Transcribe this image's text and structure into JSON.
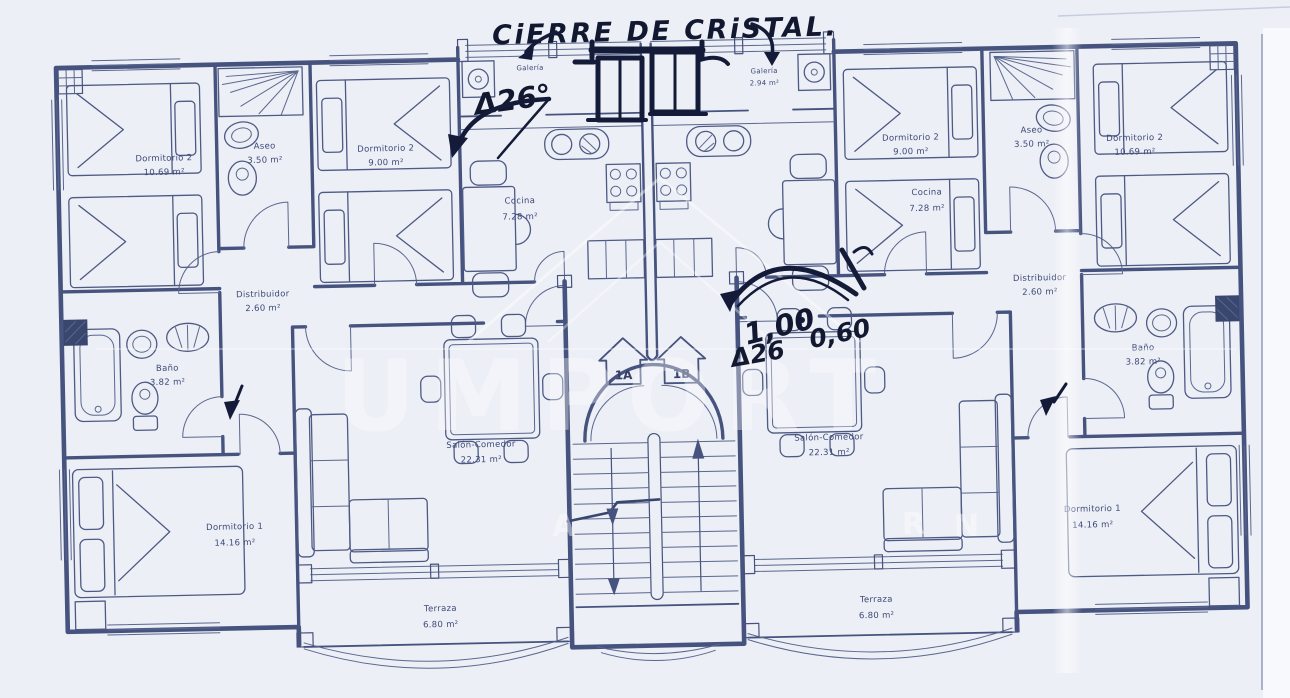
{
  "annotations": {
    "title": "CiERRE DE CRiSTAL.",
    "note_left": "Δ26°",
    "dim_a": "1,00",
    "dim_b": "0,60",
    "note_right": "Δ26"
  },
  "units": {
    "unit_a": "1A",
    "unit_b": "1B"
  },
  "rooms": {
    "left": {
      "dormitorio2_a": {
        "name": "Dormitorio 2",
        "area": "10.69 m²"
      },
      "aseo": {
        "name": "Aseo",
        "area": "3.50 m²"
      },
      "dormitorio2_b": {
        "name": "Dormitorio 2",
        "area": "9.00 m²"
      },
      "galeria": {
        "name": "Galería",
        "area": ""
      },
      "cocina": {
        "name": "Cocina",
        "area": "7.28 m²"
      },
      "distribuidor": {
        "name": "Distribuidor",
        "area": "2.60 m²"
      },
      "bano": {
        "name": "Baño",
        "area": "3.82 m²"
      },
      "salon": {
        "name": "Salón-Comedor",
        "area": "22.31 m²"
      },
      "dormitorio1": {
        "name": "Dormitorio 1",
        "area": "14.16 m²"
      },
      "terraza": {
        "name": "Terraza",
        "area": "6.80 m²"
      }
    },
    "right": {
      "galeria": {
        "name": "Galería",
        "area": "2.94 m²"
      },
      "cocina": {
        "name": "Cocina",
        "area": "7.28 m²"
      },
      "dormitorio2_b": {
        "name": "Dormitorio 2",
        "area": "9.00 m²"
      },
      "aseo": {
        "name": "Aseo",
        "area": "3.50 m²"
      },
      "dormitorio2_a": {
        "name": "Dormitorio 2",
        "area": "10.69 m²"
      },
      "distribuidor": {
        "name": "Distribuidor",
        "area": "2.60 m²"
      },
      "bano": {
        "name": "Baño",
        "area": "3.82 m²"
      },
      "salon": {
        "name": "Salón-Comedor",
        "area": "22.31 m²"
      },
      "dormitorio1": {
        "name": "Dormitorio 1",
        "area": "14.16 m²"
      },
      "terraza": {
        "name": "Terraza",
        "area": "6.80 m²"
      }
    }
  },
  "watermark": {
    "main": "UMPORT",
    "fragments": [
      "A",
      "R",
      "N"
    ]
  },
  "colors": {
    "paper": "#edeff6",
    "plan_ink": "#46537e",
    "hand_ink": "#10172e"
  }
}
